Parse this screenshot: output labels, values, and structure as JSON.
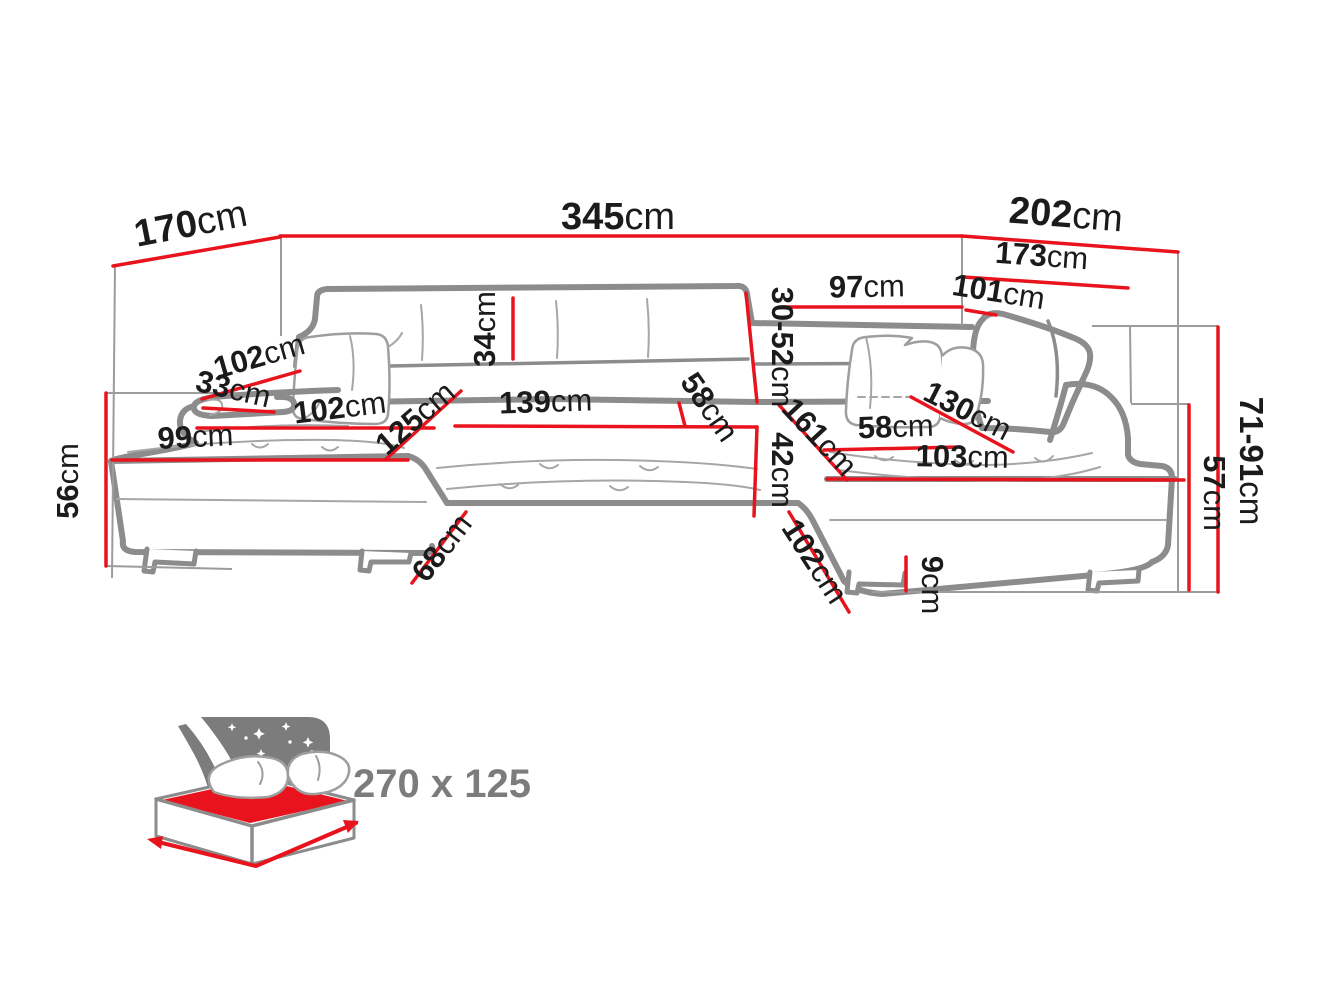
{
  "dims": {
    "d170": {
      "value": "170",
      "unit": "cm"
    },
    "d345": {
      "value": "345",
      "unit": "cm"
    },
    "d202": {
      "value": "202",
      "unit": "cm"
    },
    "d173": {
      "value": "173",
      "unit": "cm"
    },
    "d97": {
      "value": "97",
      "unit": "cm"
    },
    "d101": {
      "value": "101",
      "unit": "cm"
    },
    "d34": {
      "value": "34",
      "unit": "cm"
    },
    "d30_52": {
      "value": "30-52",
      "unit": "cm"
    },
    "d102_back": {
      "value": "102",
      "unit": "cm"
    },
    "d33": {
      "value": "33",
      "unit": "cm"
    },
    "d102_seat": {
      "value": "102",
      "unit": "cm"
    },
    "d125": {
      "value": "125",
      "unit": "cm"
    },
    "d139": {
      "value": "139",
      "unit": "cm"
    },
    "d58_mid": {
      "value": "58",
      "unit": "cm"
    },
    "d42": {
      "value": "42",
      "unit": "cm"
    },
    "d161": {
      "value": "161",
      "unit": "cm"
    },
    "d58_right": {
      "value": "58",
      "unit": "cm"
    },
    "d130": {
      "value": "130",
      "unit": "cm"
    },
    "d103": {
      "value": "103",
      "unit": "cm"
    },
    "d99": {
      "value": "99",
      "unit": "cm"
    },
    "d56": {
      "value": "56",
      "unit": "cm"
    },
    "d68": {
      "value": "68",
      "unit": "cm"
    },
    "d102_front": {
      "value": "102",
      "unit": "cm"
    },
    "d9": {
      "value": "9",
      "unit": "cm"
    },
    "d71_91": {
      "value": "71-91",
      "unit": "cm"
    },
    "d57": {
      "value": "57",
      "unit": "cm"
    }
  },
  "sleeping_area": {
    "label": "270 x 125"
  },
  "colors": {
    "dimension_red": "#e8131c",
    "sofa_outline_gray": "#8c8c8c",
    "label_color": "#1b1b1b",
    "icon_gray": "#7c7c7c"
  }
}
